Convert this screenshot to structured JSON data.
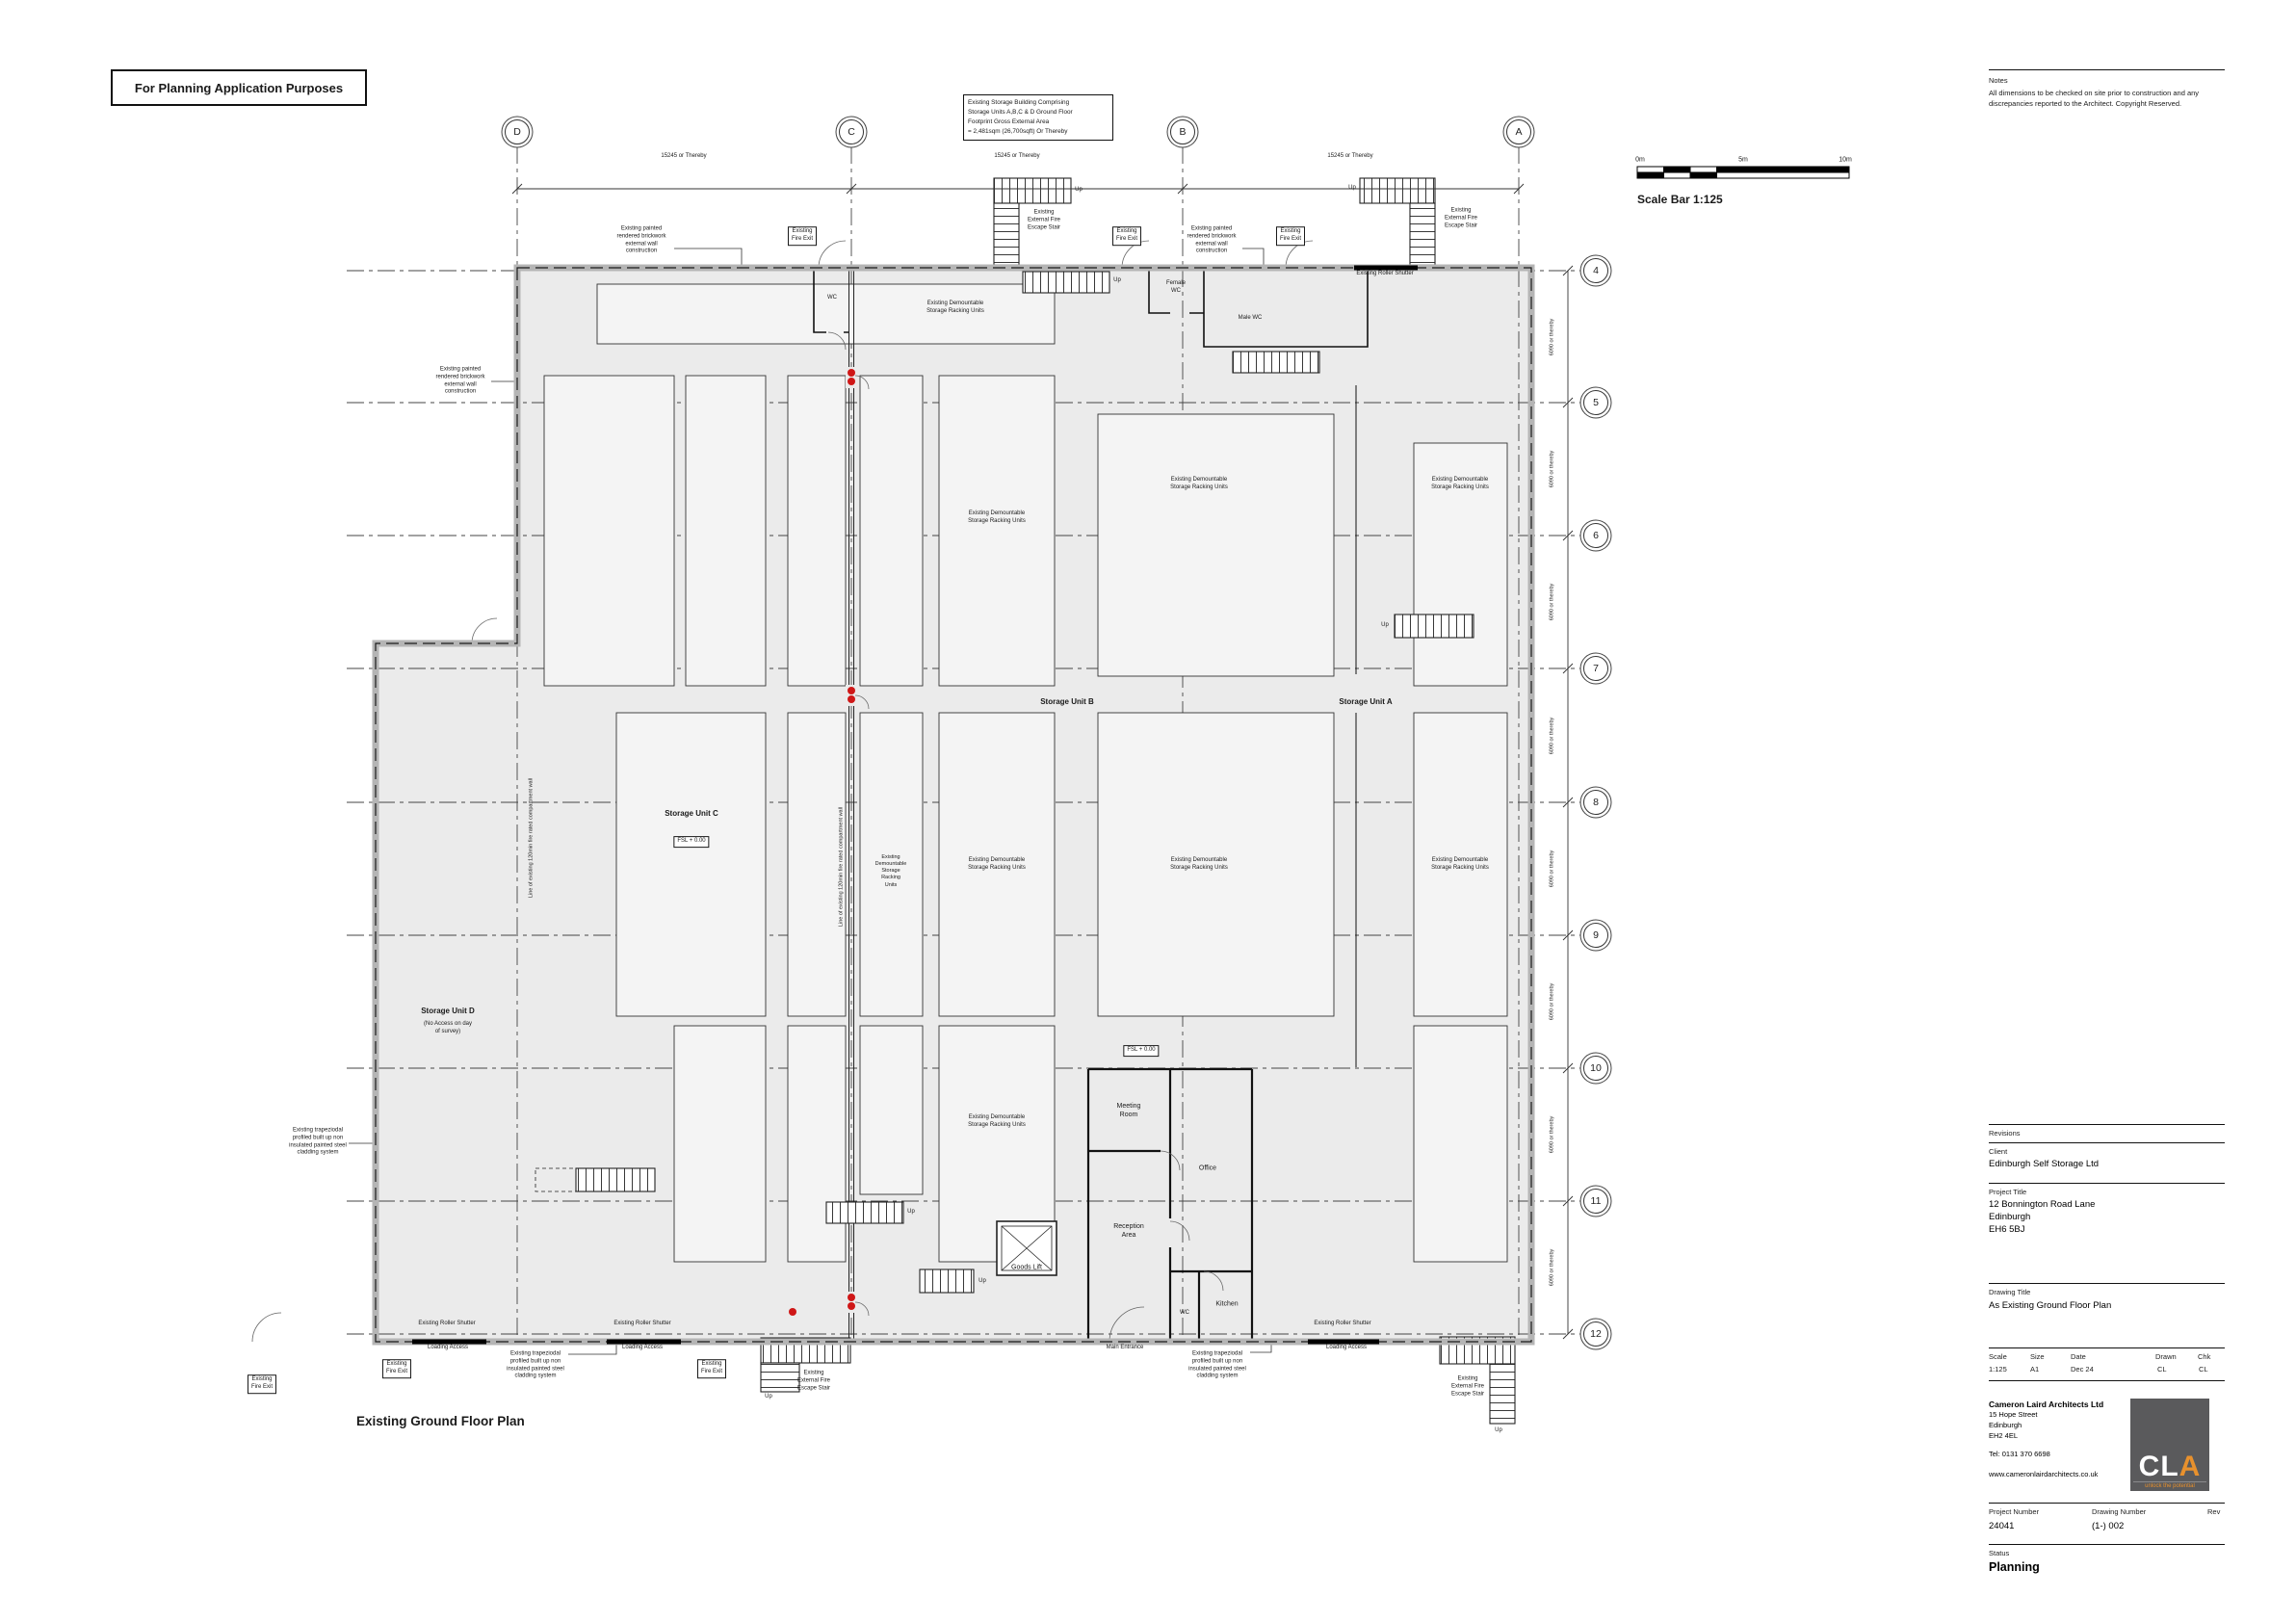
{
  "stamp": "For Planning Application Purposes",
  "area_note": [
    "Existing Storage Building Comprising",
    "Storage Units A,B,C & D Ground Floor",
    "Footprint Gross External Area",
    "= 2,481sqm (26,700sqft) Or Thereby"
  ],
  "notes": {
    "title": "Notes",
    "body": "All dimensions to be checked on site prior to construction and any discrepancies reported to the Architect. Copyright Reserved."
  },
  "scale_bar": {
    "zero": "0m",
    "five": "5m",
    "ten": "10m",
    "caption": "Scale Bar 1:125"
  },
  "grid": {
    "letters": [
      "D",
      "C",
      "B",
      "A"
    ],
    "numbers": [
      "4",
      "5",
      "6",
      "7",
      "8",
      "9",
      "10",
      "11",
      "12"
    ],
    "h_dim": "15245 or Thereby",
    "v_dim": "6090 or thereby"
  },
  "plan_title": "Existing Ground Floor Plan",
  "labels": {
    "racking": [
      "Existing Demountable",
      "Storage Racking Units"
    ],
    "racking_stack": [
      "Existing",
      "Demountable",
      "Storage",
      "Racking",
      "Units"
    ],
    "brickwork": [
      "Existing painted",
      "rendered brickwork",
      "external wall",
      "construction"
    ],
    "cladding": [
      "Existing trapeziodal",
      "profiled built up non",
      "insulated painted steel",
      "cladding system"
    ],
    "fire_exit": [
      "Existing",
      "Fire Exit"
    ],
    "escape_stair": [
      "Existing",
      "External Fire",
      "Escape Stair"
    ],
    "roller_shutter": "Existing Roller Shutter",
    "loading_access": "Loading Access",
    "main_entrance": "Main Entrance",
    "compartment_wall": "Line of existing 120min fire rated compartment wall",
    "up": "Up",
    "wc": "WC",
    "female_wc": [
      "Female",
      "WC"
    ],
    "male_wc": "Male WC",
    "ffl": "FSL + 0.00",
    "storage_a": "Storage Unit A",
    "storage_b": "Storage Unit B",
    "storage_c": "Storage Unit C",
    "storage_d": "Storage Unit D",
    "storage_d_note": [
      "(No  Access on day",
      "of survey)"
    ],
    "meeting_room": [
      "Meeting",
      "Room"
    ],
    "office": "Office",
    "reception": [
      "Reception",
      "Area"
    ],
    "goods_lift": "Goods Lift",
    "kitchen": "Kitchen"
  },
  "titleblock": {
    "revisions_label": "Revisions",
    "client_label": "Client",
    "client": "Edinburgh Self Storage Ltd",
    "project_title_label": "Project Title",
    "project_address": [
      "12 Bonnington Road Lane",
      "Edinburgh",
      "EH6 5BJ"
    ],
    "drawing_title_label": "Drawing Title",
    "drawing_title": "As Existing Ground Floor Plan",
    "scale_label": "Scale",
    "scale": "1:125",
    "size_label": "Size",
    "size": "A1",
    "date_label": "Date",
    "date": "Dec 24",
    "drawn_label": "Drawn",
    "drawn": "CL",
    "chk_label": "Chk",
    "chk": "CL",
    "architect_name": "Cameron Laird Architects Ltd",
    "architect_address": [
      "15 Hope Street",
      "Edinburgh",
      "EH2 4EL"
    ],
    "architect_tel": "Tel: 0131 370 6698",
    "architect_web": "www.cameronlairdarchitects.co.uk",
    "project_number_label": "Project Number",
    "project_number": "24041",
    "drawing_number_label": "Drawing Number",
    "drawing_number": "(1-) 002",
    "rev_label": "Rev",
    "status_label": "Status",
    "status": "Planning"
  },
  "logo": {
    "cl": "CL",
    "a": "A",
    "tagline": "unlock the potential"
  },
  "colors": {
    "accent_red": "#cf1717",
    "logo_grey": "#5a5a5c",
    "logo_orange": "#e8912d",
    "floor_fill": "#ebebeb"
  }
}
